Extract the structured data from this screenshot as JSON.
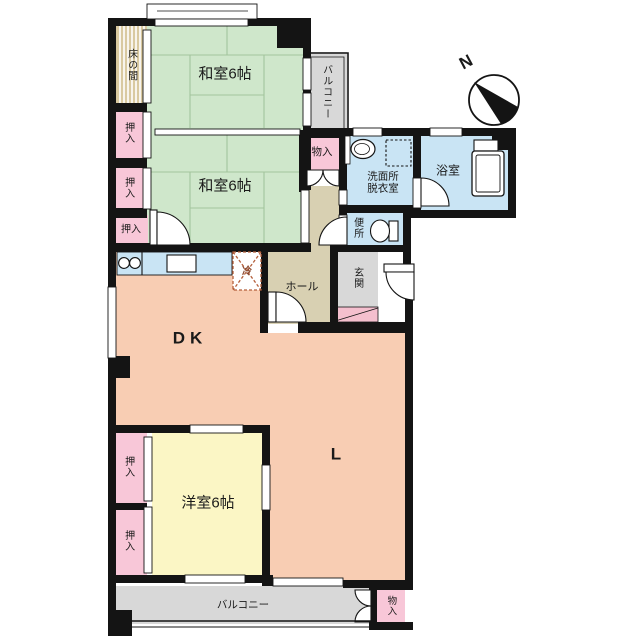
{
  "plan": {
    "title": "apartment-floor-plan",
    "rooms": {
      "washitsu_upper": {
        "label": "和室6帖"
      },
      "washitsu_lower": {
        "label": "和室6帖"
      },
      "yoshitsu": {
        "label": "洋室6帖"
      },
      "dining_kitchen": {
        "label": "DK"
      },
      "living": {
        "label": "L"
      },
      "hall": {
        "label": "ホール"
      },
      "genkan": {
        "label": "玄関"
      },
      "washroom": {
        "label": "洗面所\n脱衣室"
      },
      "bathroom": {
        "label": "浴室"
      },
      "toilet": {
        "label": "便所"
      },
      "tokonoma": {
        "label": "床の間"
      },
      "balcony_top": {
        "label": "バルコニー"
      },
      "balcony_bottom": {
        "label": "バルコニー"
      },
      "storage_top": {
        "label": "物入"
      },
      "storage_bottom": {
        "label": "物入"
      },
      "closet_1": {
        "label": "押入"
      },
      "closet_2": {
        "label": "押入"
      },
      "closet_3": {
        "label": "押入"
      },
      "closet_4": {
        "label": "押入"
      },
      "closet_5": {
        "label": "押入"
      },
      "refrigerator": {
        "label": "冷"
      }
    },
    "compass": {
      "label": "N"
    },
    "colors": {
      "wall": "#141414",
      "tatami_green": "#cfe7cb",
      "tatami_line": "#a3c49d",
      "closet_pink": "#f8c7d8",
      "floor_peach": "#f8cdb3",
      "western_room_yellow": "#fbf6c5",
      "wet_area_blue": "#c9e4f4",
      "balcony_gray": "#d8d8d8",
      "hall_beige": "#d8d0b2",
      "tokonoma_tan": "#d9c9a0",
      "step_pink": "#f4bfce",
      "refrigerator_accent": "#b5603c"
    }
  }
}
